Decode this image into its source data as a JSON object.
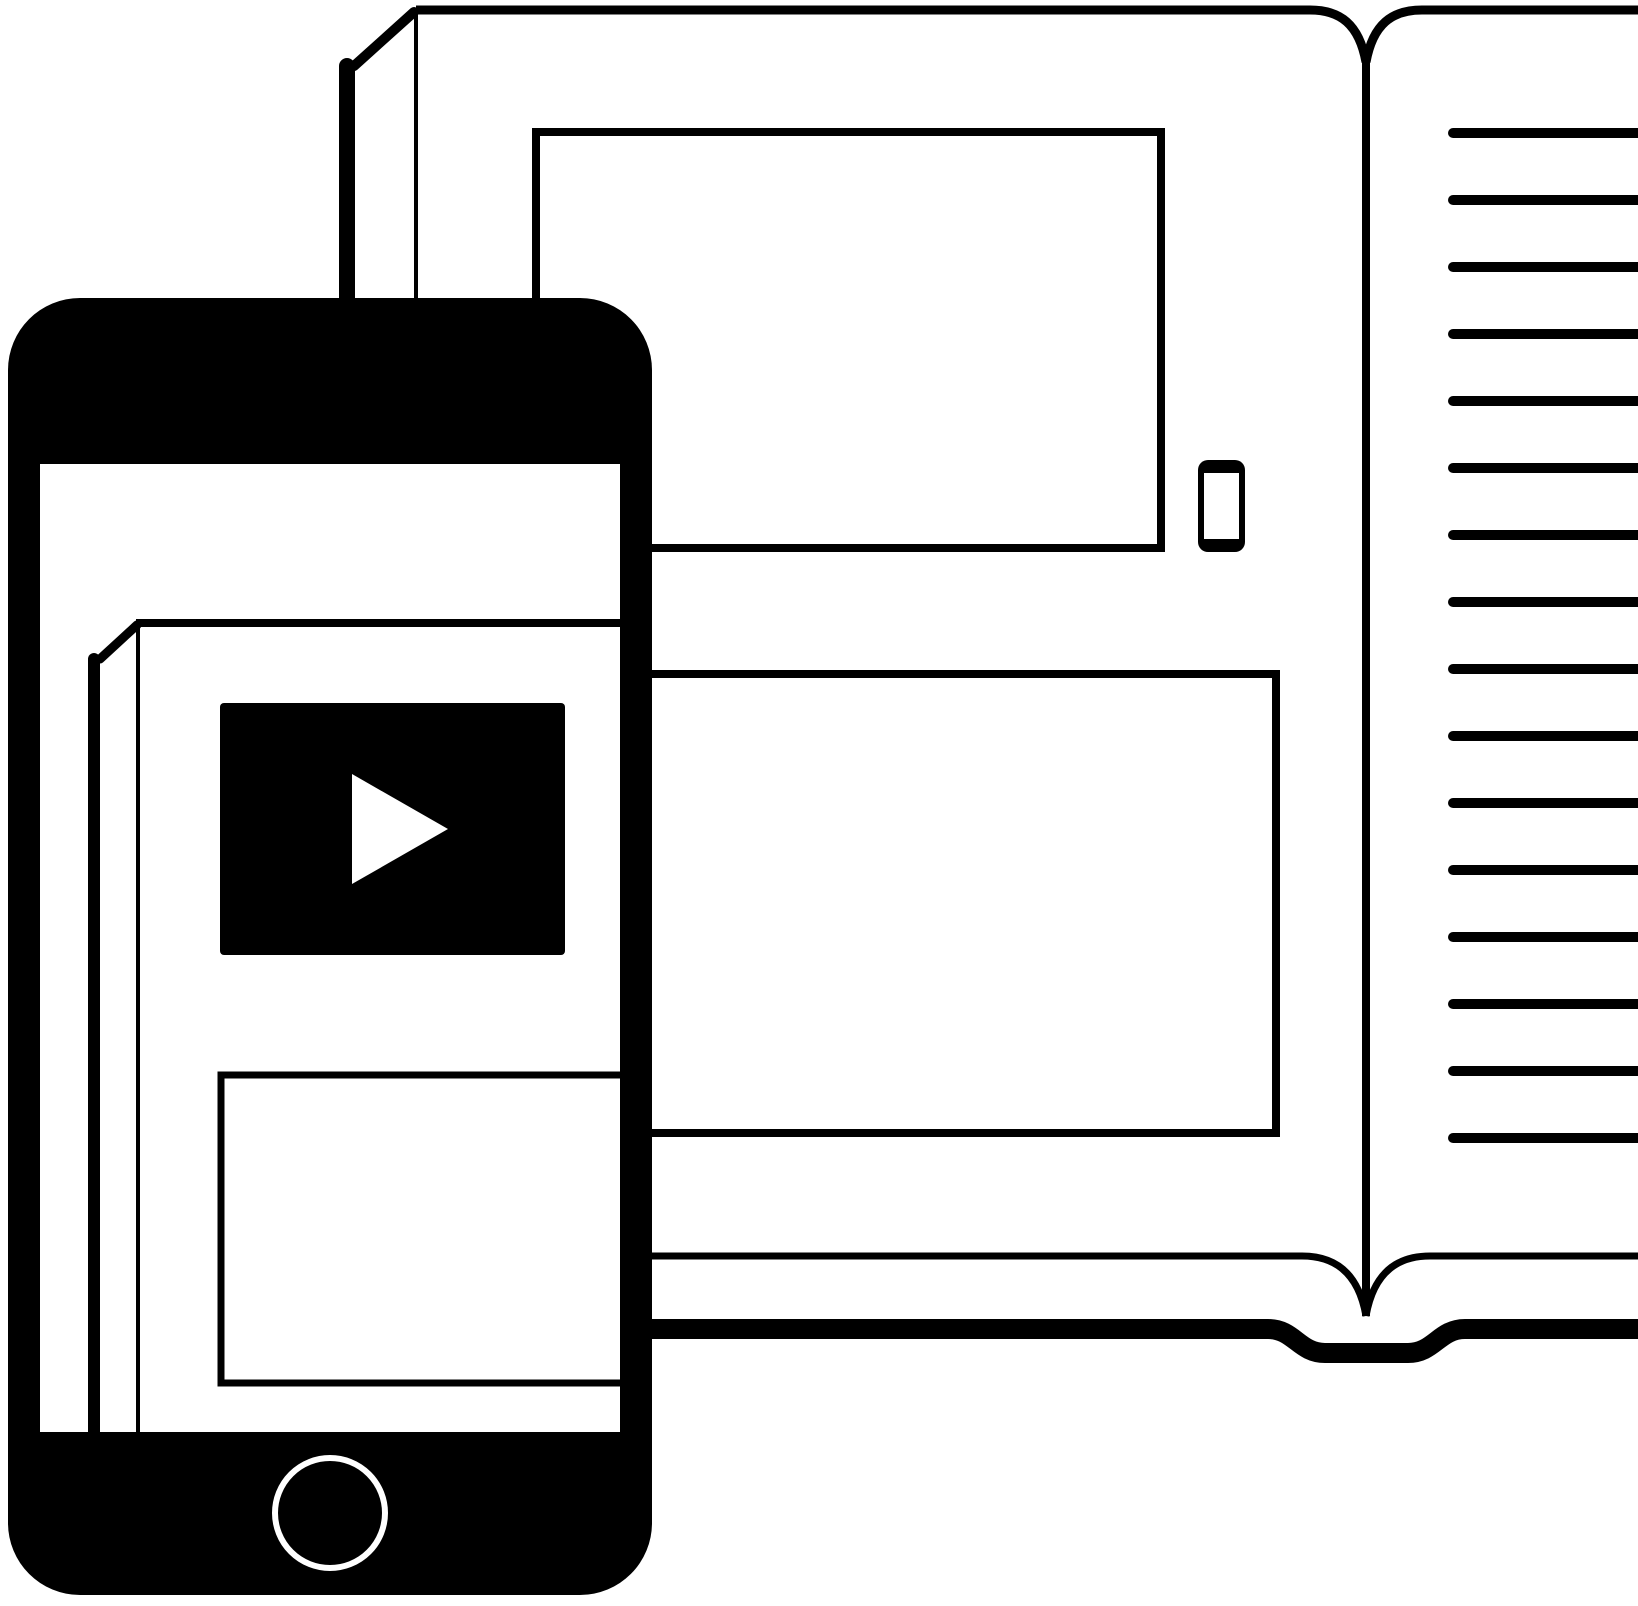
{
  "meta": {
    "type": "vector-illustration",
    "subject": "open book with smartphone playing video content",
    "text_content": "none"
  },
  "colors": {
    "ink": "#000000",
    "paper": "#ffffff"
  },
  "book": {
    "right_page": {
      "ruled_lines": {
        "count": 16,
        "x": 1453,
        "length": 210,
        "y_first": 133,
        "spacing": 67,
        "thickness": 10
      }
    },
    "left_page": {
      "image_placeholder_count": 2,
      "has_phone_glyph": true
    },
    "has_page_stack_edge": true,
    "has_back_cover": true
  },
  "smartphone": {
    "has_video_player": true,
    "has_play_button": true,
    "has_home_button": true,
    "has_content_card": true,
    "has_page_stack_edge": true
  }
}
